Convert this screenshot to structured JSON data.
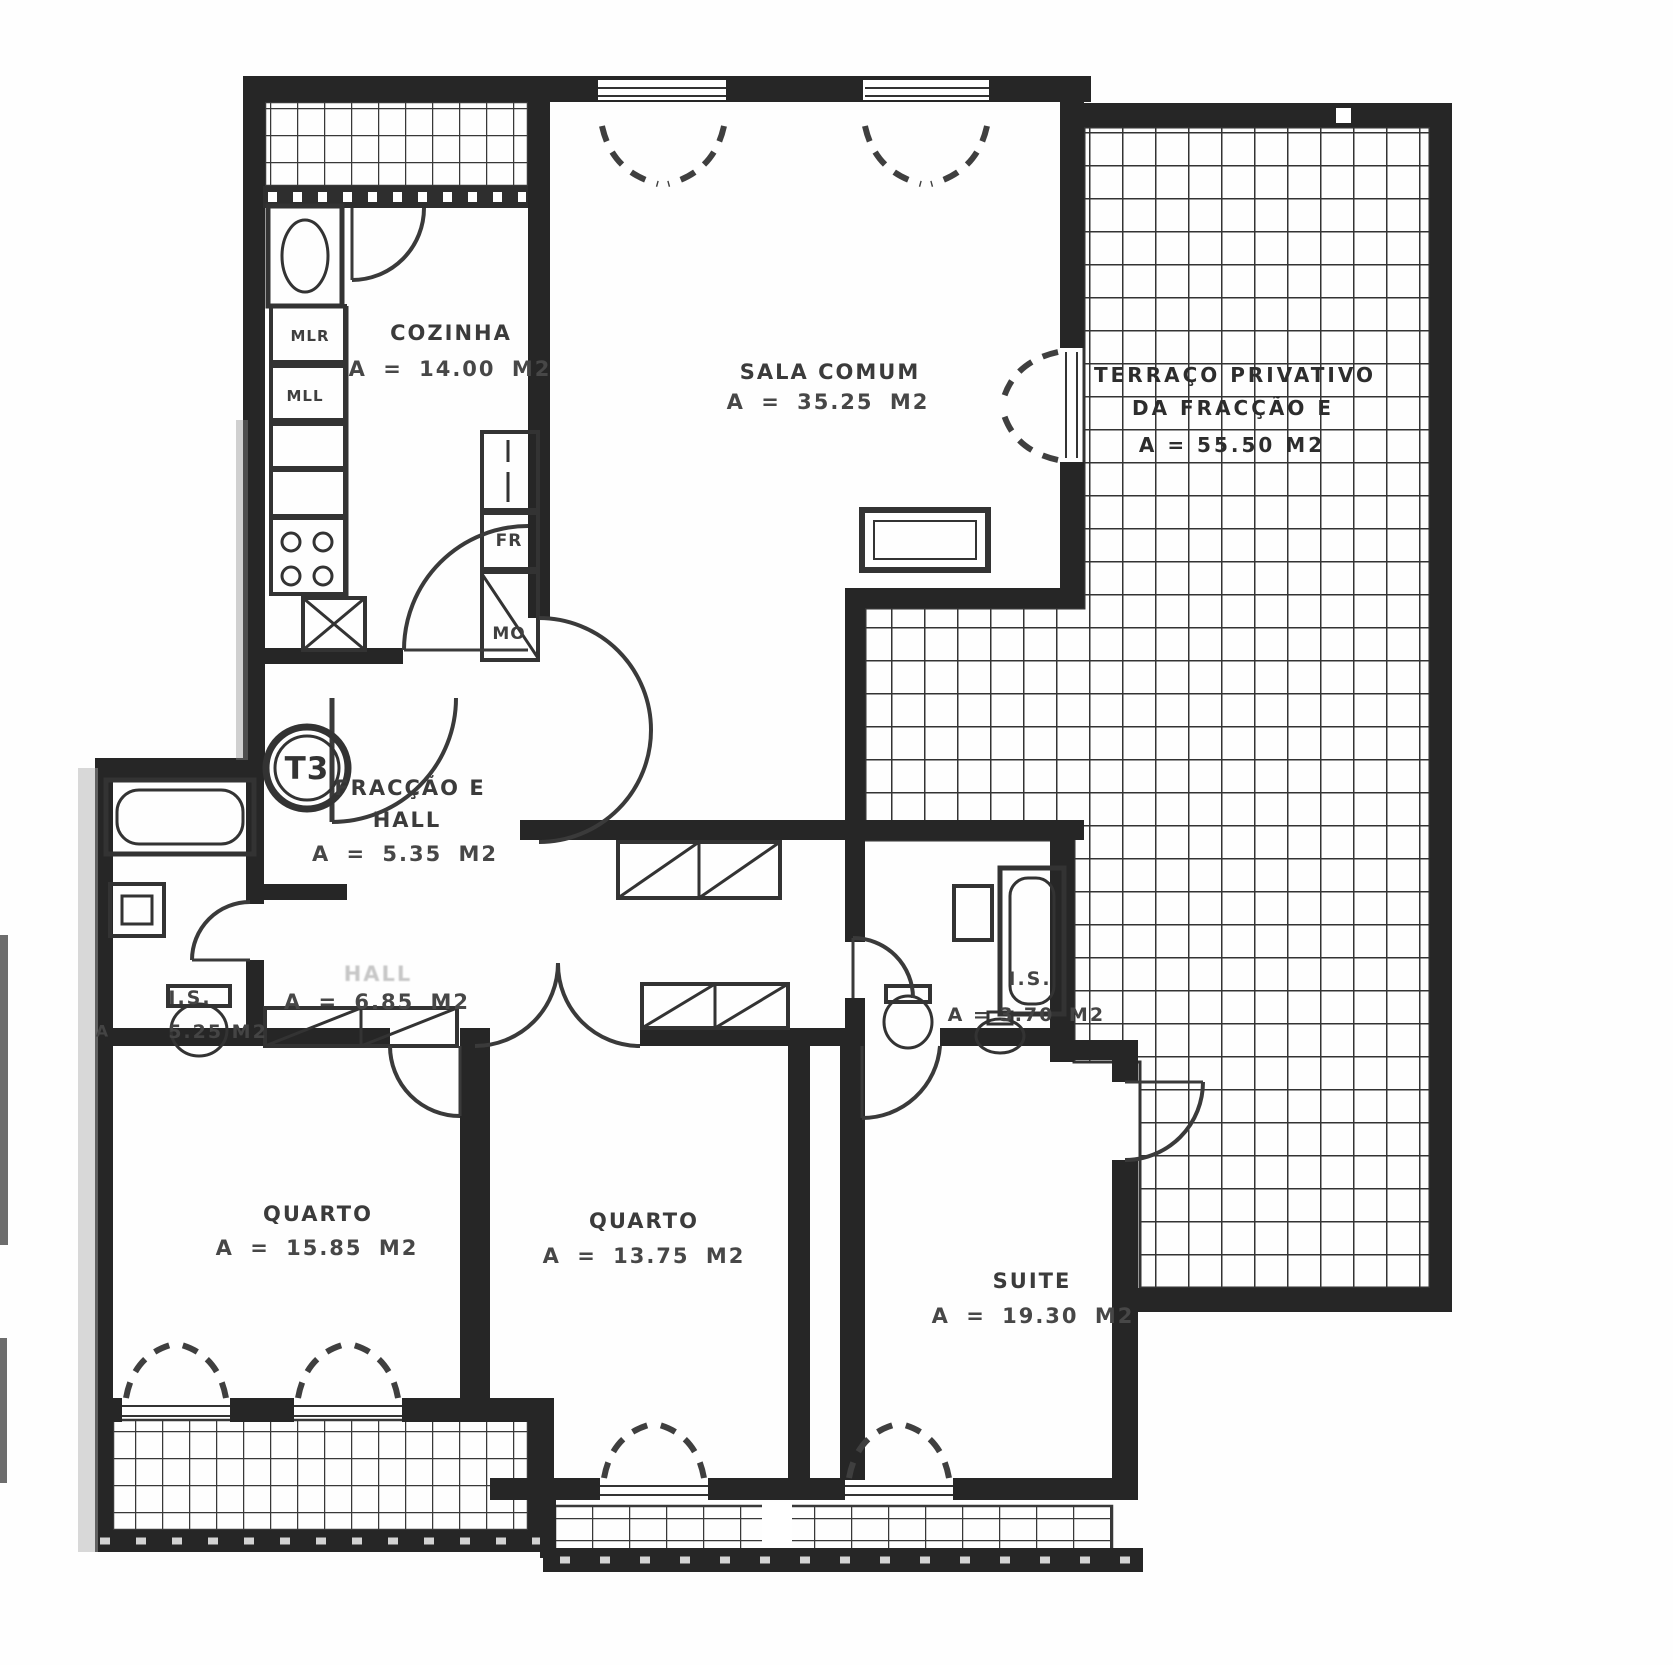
{
  "plan": {
    "badge": "T3",
    "ink_color": "#2b2b2b",
    "rooms": {
      "cozinha": {
        "name": "COZINHA",
        "area": "A = 14.00 M2"
      },
      "sala": {
        "name": "SALA COMUM",
        "area": "A = 35.25 M2"
      },
      "terraco": {
        "line1": "TERRAÇO PRIVATIVO",
        "line2": "DA FRACÇÃO E",
        "line3": "A = 55.50 M2"
      },
      "fraccao_hall": {
        "line1": "FRACÇÃO E",
        "line2": "HALL",
        "area": "A = 5.35 M2"
      },
      "corredor": {
        "name": "HALL",
        "area": "A = 6.85 M2"
      },
      "is1": {
        "name": "I.S.",
        "prefix": "A",
        "area": "5.25 M2"
      },
      "is2": {
        "name": "I.S.",
        "area": "A = 3.70",
        "unit": "M2"
      },
      "quarto1": {
        "name": "QUARTO",
        "area": "A = 15.85 M2"
      },
      "quarto2": {
        "name": "QUARTO",
        "area": "A = 13.75 M2"
      },
      "suite": {
        "name": "SUITE",
        "area": "A = 19.30 M2"
      }
    },
    "appliances": {
      "mlr": "MLR",
      "mll": "MLL",
      "fr": "FR",
      "mo": "MO"
    }
  }
}
